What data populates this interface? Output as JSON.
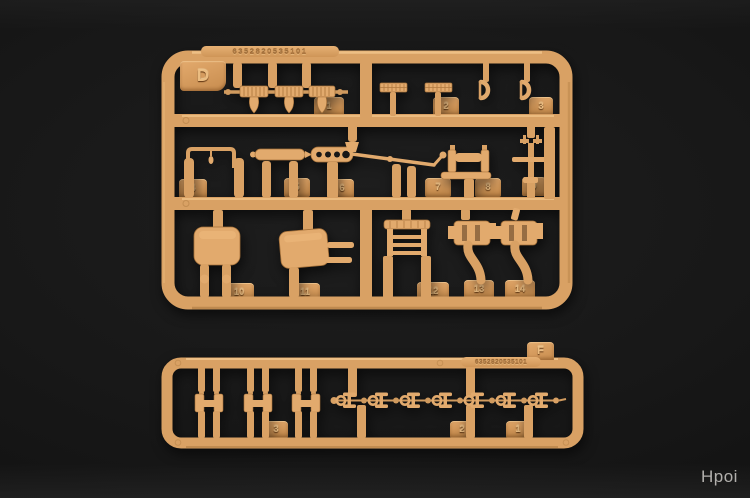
{
  "photo": {
    "watermark": "Hpoi"
  },
  "colors": {
    "background": "#161616",
    "plastic": "#d9a164",
    "plastic_highlight": "#f2c58b",
    "plastic_shadow": "#a9763e",
    "watermark": "#b2b0ad"
  },
  "sprue_d": {
    "label": "D",
    "mold_number": "6352820535101",
    "parts": [
      "1",
      "2",
      "3",
      "4",
      "5",
      "6",
      "7",
      "8",
      "9",
      "10",
      "11",
      "12",
      "13",
      "14"
    ]
  },
  "sprue_f": {
    "label": "F",
    "mold_number": "6352820535101",
    "parts": [
      "3",
      "2",
      "1"
    ]
  }
}
